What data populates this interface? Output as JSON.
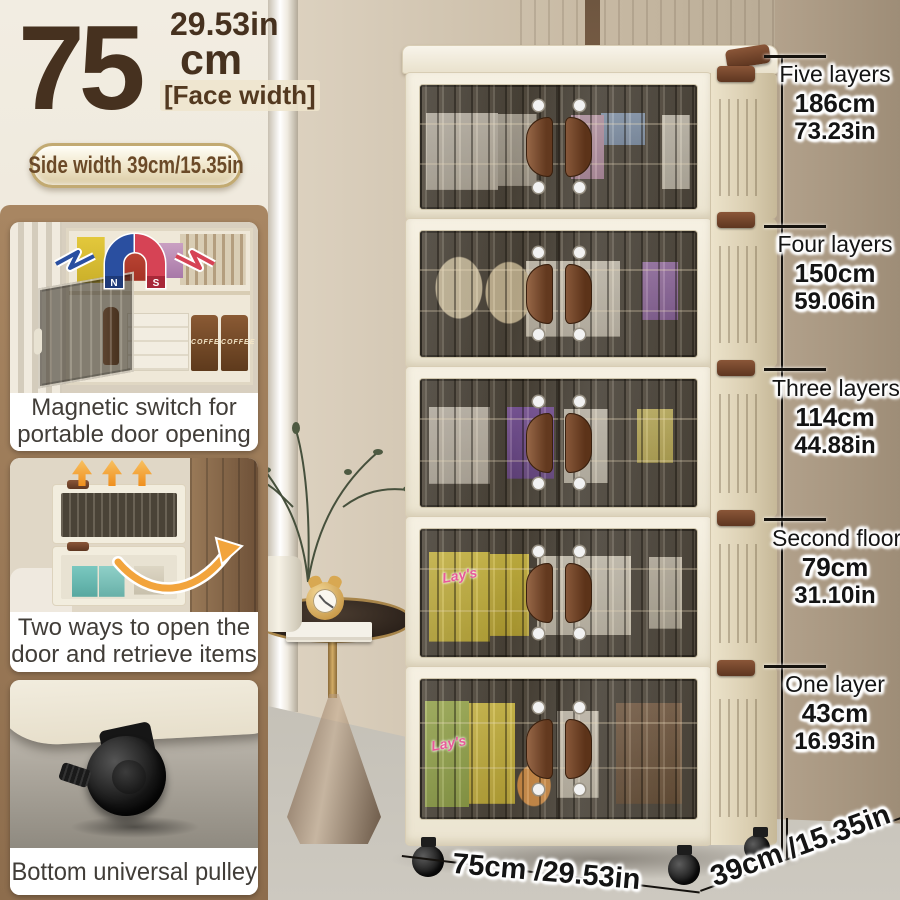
{
  "size_callout": {
    "inches_label": "29.53in",
    "value": "75",
    "unit": "cm",
    "qualifier": "[Face width]",
    "side_width": "Side width 39cm/15.35in"
  },
  "feature_cards": [
    {
      "caption_lines": [
        "Magnetic switch for",
        "portable door opening"
      ],
      "icon": "magnet-icon",
      "magnet_north": "N",
      "magnet_south": "S",
      "coffee_label": "COFFEE"
    },
    {
      "caption_lines": [
        "Two ways to open the",
        "door and retrieve items"
      ],
      "icon": "up-arrows-and-curved-arrow"
    },
    {
      "caption_lines": [
        "Bottom universal pulley"
      ],
      "icon": "caster-wheel"
    }
  ],
  "height_ruler": {
    "items": [
      {
        "label": "Five layers",
        "cm": "186cm",
        "inches": "73.23in"
      },
      {
        "label": "Four layers",
        "cm": "150cm",
        "inches": "59.06in"
      },
      {
        "label": "Three layers",
        "cm": "114cm",
        "inches": "44.88in"
      },
      {
        "label": "Second floor",
        "cm": "79cm",
        "inches": "31.10in"
      },
      {
        "label": "One layer",
        "cm": "43cm",
        "inches": "16.93in"
      }
    ]
  },
  "base_dimensions": {
    "width": "75cm /29.53in",
    "depth": "39cm /15.35in"
  },
  "photo_texts": {
    "chips_brand": "Lay's"
  },
  "colors": {
    "accent_text_brown": "#46311f",
    "panel_brown": "#9b7a58",
    "magnet_blue": "#2a4fa0",
    "magnet_red": "#d64355",
    "arrow_orange": "#f2a43c",
    "cabinet_cream": "#f2edde"
  }
}
